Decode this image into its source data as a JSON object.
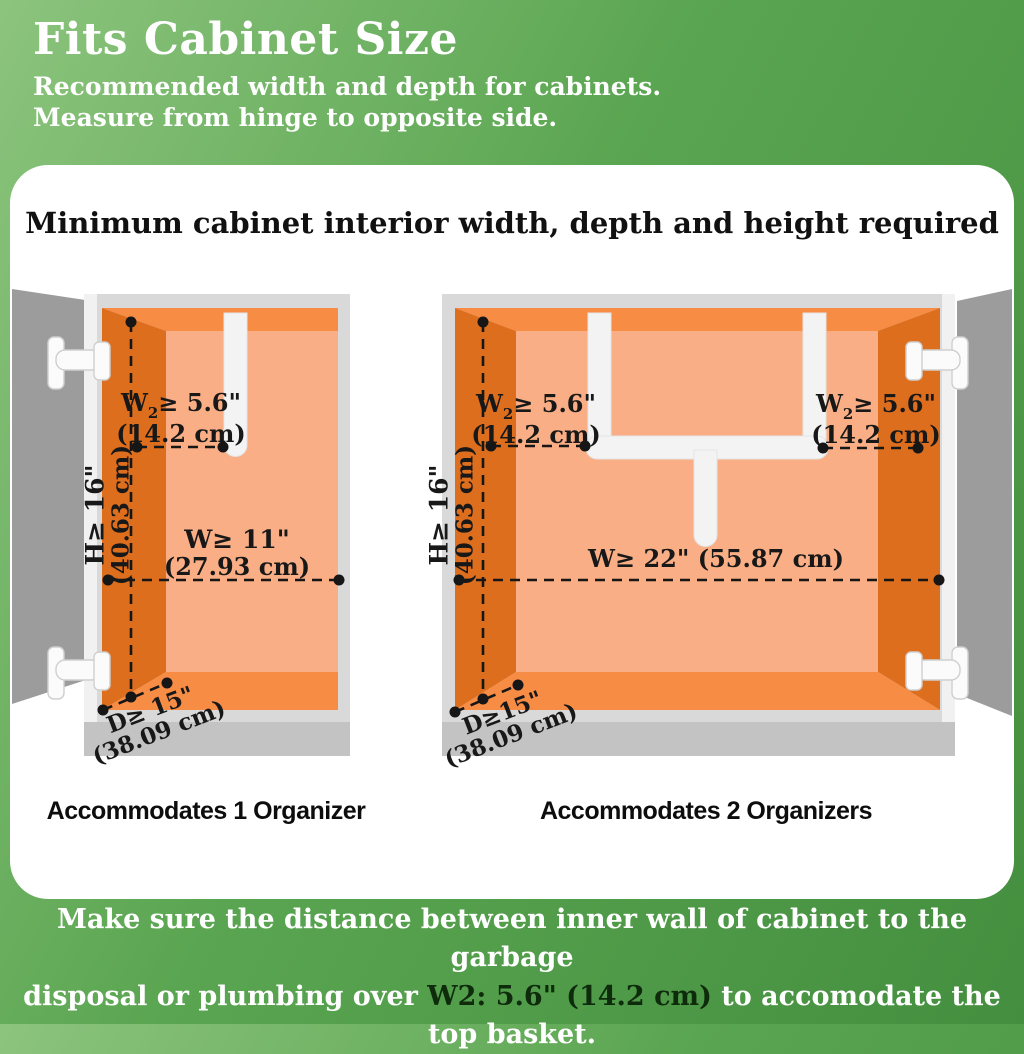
{
  "header": {
    "title": "Fits Cabinet Size",
    "subtitle_line1": "Recommended width and depth for cabinets.",
    "subtitle_line2": "Measure from hinge to opposite side."
  },
  "card": {
    "title": "Minimum cabinet interior width, depth and height required"
  },
  "dimensions": {
    "w2": {
      "prefix": "W",
      "sub": "2",
      "suffix": "≥ 5.6\"",
      "metric": "(14.2 cm)"
    },
    "height": {
      "label": "H≥ 16\"",
      "metric": "(40.63 cm)"
    },
    "width_single": {
      "label": "W≥ 11\"",
      "metric": "(27.93 cm)"
    },
    "width_double": {
      "label": "W≥ 22\" (55.87 cm)"
    },
    "depth": {
      "label": "D≥ 15\"",
      "metric": "(38.09 cm)"
    },
    "depth_right": {
      "label": "D≥15\"",
      "metric": "(38.09 cm)"
    }
  },
  "captions": {
    "left": "Accommodates 1 Organizer",
    "right": "Accommodates 2 Organizers"
  },
  "note": {
    "line1": "Make sure the distance between inner wall of cabinet to the garbage",
    "line2_pre": "disposal or plumbing over ",
    "line2_highlight": "W2: 5.6\" (14.2 cm)",
    "line2_post": " to accomodate the top basket."
  },
  "colors": {
    "header_green": "#5aa551",
    "wall_dark_orange": "#dd6e1e",
    "wall_strip_orange": "#f78c45",
    "back_wall_orange": "#f9ae85",
    "frame_gray": "#d9d9d9",
    "door_gray": "#9c9c9c",
    "pipe_white": "#f3f3f3",
    "note_highlight": "#0e2b0c"
  }
}
